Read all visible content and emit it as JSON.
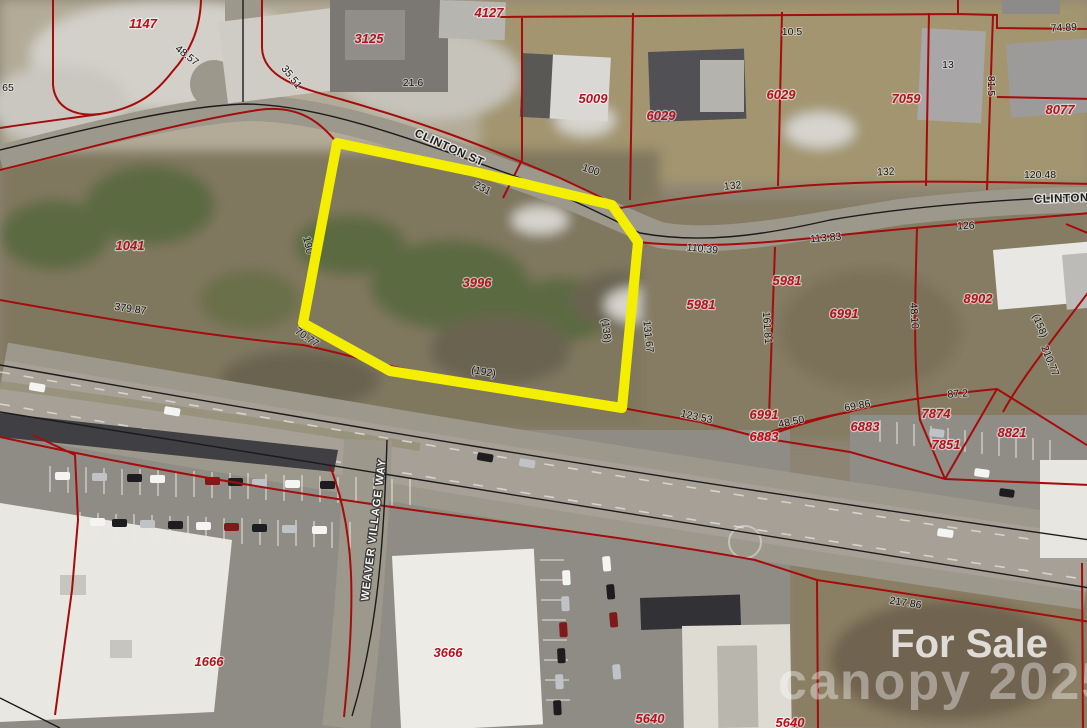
{
  "map": {
    "type": "aerial-parcel-map",
    "featured_parcel": {
      "id": "3996",
      "outline_color": "#f4ef00"
    },
    "parcel_labels": [
      "1147",
      "3125",
      "4127",
      "5009",
      "6029",
      "6029",
      "7059",
      "8077",
      "1041",
      "3996",
      "5981",
      "5981",
      "6991",
      "8902",
      "6991",
      "6883",
      "6883",
      "7874",
      "7851",
      "8821",
      "1666",
      "3666",
      "5640",
      "5640"
    ],
    "dimension_labels": [
      "48.57",
      "35.51",
      "21.6",
      "65",
      "10.5",
      "13",
      "74.89",
      "81.5",
      "100",
      "132",
      "132",
      "120.48",
      "126",
      "110.39",
      "113.83",
      "231",
      "190",
      "(138)",
      "131.67",
      "(192)",
      "70.77",
      "379.87",
      "123.53",
      "48.50",
      "69.86",
      "87.2",
      "161.81",
      "48.10",
      "(158)",
      "210.77",
      "217.86"
    ],
    "street_labels": [
      "CLINTON ST",
      "CLINTON",
      "WEAVER VILLAGE WAY"
    ],
    "colors": {
      "parcel_line": "#a50c0c",
      "highlight": "#f4ef00",
      "parcel_text": "#b5121c",
      "dimension_text": "#141414"
    }
  },
  "watermark": {
    "for_sale": "For Sale",
    "brand_line": "canopy 2025"
  }
}
